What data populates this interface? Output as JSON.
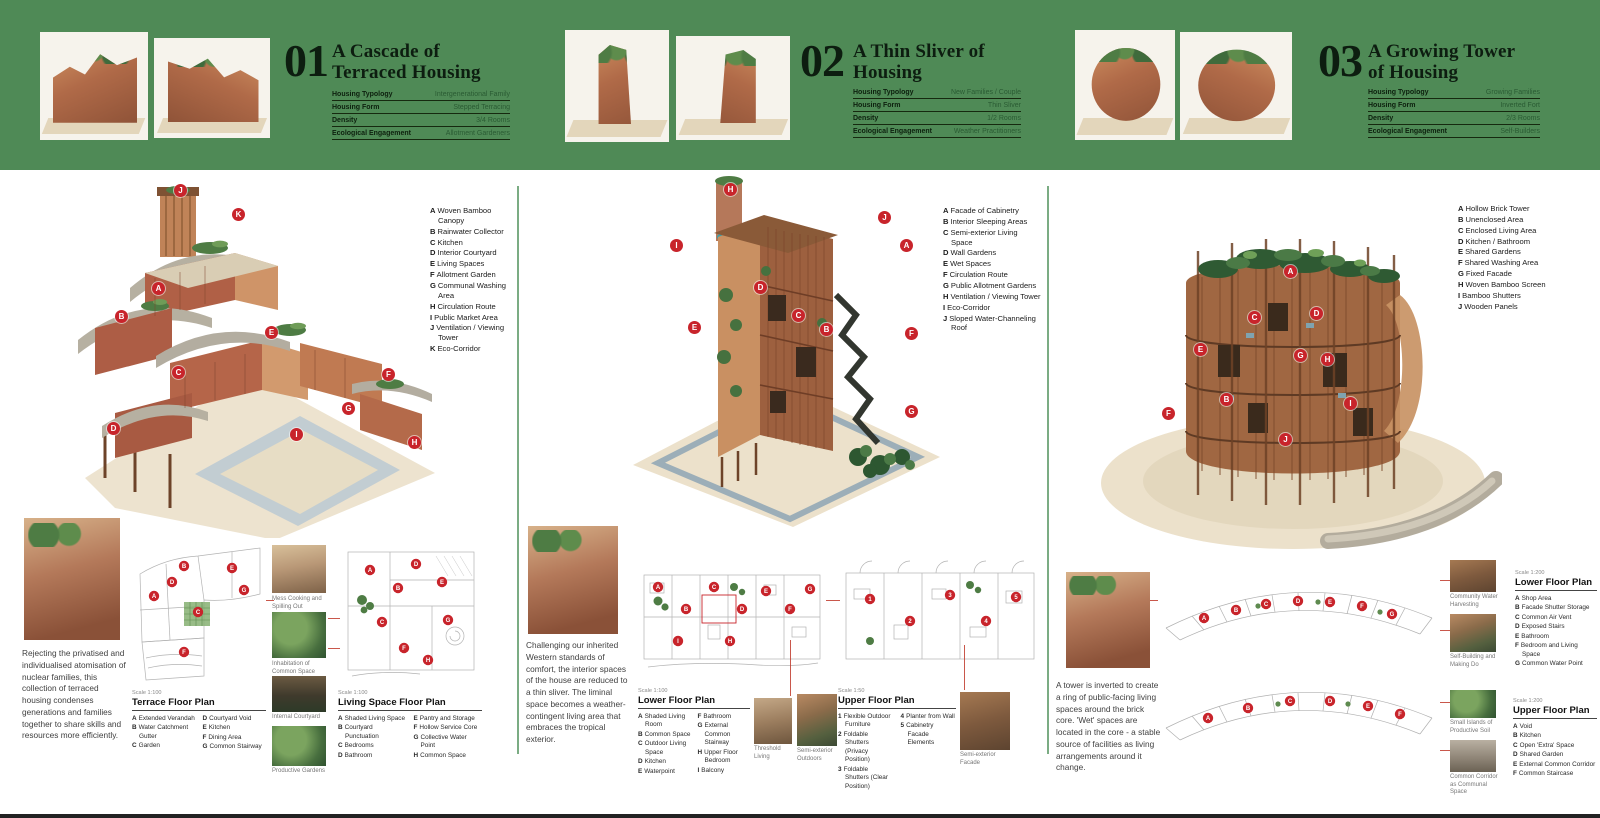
{
  "banner": {
    "bg": "#4f8a56",
    "sections": [
      {
        "number": "01",
        "title1": "A Cascade of",
        "title2": "Terraced Housing",
        "rows": [
          {
            "label": "Housing Typology",
            "value": "Intergenerational Family"
          },
          {
            "label": "Housing Form",
            "value": "Stepped Terracing"
          },
          {
            "label": "Density",
            "value": "3/4 Rooms"
          },
          {
            "label": "Ecological Engagement",
            "value": "Allotment Gardeners"
          }
        ]
      },
      {
        "number": "02",
        "title1": "A Thin Sliver of",
        "title2": "Housing",
        "rows": [
          {
            "label": "Housing Typology",
            "value": "New Families / Couple"
          },
          {
            "label": "Housing Form",
            "value": "Thin Sliver"
          },
          {
            "label": "Density",
            "value": "1/2 Rooms"
          },
          {
            "label": "Ecological Engagement",
            "value": "Weather Practitioners"
          }
        ]
      },
      {
        "number": "03",
        "title1": "A Growing Tower",
        "title2": "of Housing",
        "rows": [
          {
            "label": "Housing Typology",
            "value": "Growing Families"
          },
          {
            "label": "Housing Form",
            "value": "Inverted Fort"
          },
          {
            "label": "Density",
            "value": "2/3 Rooms"
          },
          {
            "label": "Ecological Engagement",
            "value": "Self-Builders"
          }
        ]
      }
    ]
  },
  "panels": [
    {
      "legend": [
        {
          "k": "A",
          "t": "Woven Bamboo Canopy"
        },
        {
          "k": "B",
          "t": "Rainwater Collector"
        },
        {
          "k": "C",
          "t": "Kitchen"
        },
        {
          "k": "D",
          "t": "Interior Courtyard"
        },
        {
          "k": "E",
          "t": "Living Spaces"
        },
        {
          "k": "F",
          "t": "Allotment Garden"
        },
        {
          "k": "G",
          "t": "Communal Washing Area"
        },
        {
          "k": "H",
          "t": "Circulation Route"
        },
        {
          "k": "I",
          "t": "Public Market Area"
        },
        {
          "k": "J",
          "t": "Ventilation / Viewing Tower"
        },
        {
          "k": "K",
          "t": "Eco-Corridor"
        }
      ],
      "model_markers": [
        "A",
        "B",
        "C",
        "D",
        "E",
        "F",
        "G",
        "H",
        "I",
        "J",
        "K"
      ],
      "description": "Rejecting the privatised and individualised atomisation of nuclear families, this collection of terraced housing condenses generations and families together to share skills and resources more efficiently.",
      "photo_captions": [
        "Mess Cooking and Spilling Out",
        "Inhabitation of Common Space",
        "Internal Courtyard",
        "Productive Gardens"
      ],
      "plans": [
        {
          "scale": "Scale 1:100",
          "title": "Terrace Floor Plan",
          "markers": [
            "A",
            "B",
            "C",
            "D",
            "E",
            "F",
            "G"
          ],
          "col1": [
            {
              "k": "A",
              "t": "Extended Verandah"
            },
            {
              "k": "B",
              "t": "Water Catchment Gutter"
            },
            {
              "k": "C",
              "t": "Garden"
            }
          ],
          "col2": [
            {
              "k": "D",
              "t": "Courtyard Void"
            },
            {
              "k": "E",
              "t": "Kitchen"
            },
            {
              "k": "F",
              "t": "Dining Area"
            },
            {
              "k": "G",
              "t": "Common Stairway"
            }
          ]
        },
        {
          "scale": "Scale 1:100",
          "title": "Living Space Floor Plan",
          "markers": [
            "A",
            "B",
            "C",
            "D",
            "E",
            "F",
            "G",
            "H"
          ],
          "col1": [
            {
              "k": "A",
              "t": "Shaded Living Space"
            },
            {
              "k": "B",
              "t": "Courtyard Punctuation"
            },
            {
              "k": "C",
              "t": "Bedrooms"
            },
            {
              "k": "D",
              "t": "Bathroom"
            }
          ],
          "col2": [
            {
              "k": "E",
              "t": "Pantry and Storage"
            },
            {
              "k": "F",
              "t": "Hollow Service Core"
            },
            {
              "k": "G",
              "t": "Collective Water Point"
            },
            {
              "k": "H",
              "t": "Common Space"
            }
          ]
        }
      ]
    },
    {
      "legend": [
        {
          "k": "A",
          "t": "Facade of Cabinetry"
        },
        {
          "k": "B",
          "t": "Interior Sleeping Areas"
        },
        {
          "k": "C",
          "t": "Semi-exterior Living Space"
        },
        {
          "k": "D",
          "t": "Wall Gardens"
        },
        {
          "k": "E",
          "t": "Wet Spaces"
        },
        {
          "k": "F",
          "t": "Circulation Route"
        },
        {
          "k": "G",
          "t": "Public Allotment Gardens"
        },
        {
          "k": "H",
          "t": "Ventilation / Viewing Tower"
        },
        {
          "k": "I",
          "t": "Eco-Corridor"
        },
        {
          "k": "J",
          "t": "Sloped Water-Channeling Roof"
        }
      ],
      "model_markers": [
        "A",
        "B",
        "C",
        "D",
        "E",
        "F",
        "G",
        "H",
        "I",
        "J"
      ],
      "description": "Challenging our inherited Western standards of comfort, the interior spaces of the house are reduced to a thin sliver. The liminal space becomes a weather-contingent living area that embraces the tropical exterior.",
      "plans": [
        {
          "scale": "Scale 1:100",
          "title": "Lower Floor Plan",
          "markers": [
            "A",
            "B",
            "C",
            "D",
            "E",
            "F",
            "G",
            "H",
            "I"
          ],
          "col1": [
            {
              "k": "A",
              "t": "Shaded Living Room"
            },
            {
              "k": "B",
              "t": "Common Space"
            },
            {
              "k": "C",
              "t": "Outdoor Living Space"
            },
            {
              "k": "D",
              "t": "Kitchen"
            },
            {
              "k": "E",
              "t": "Waterpoint"
            }
          ],
          "col2": [
            {
              "k": "F",
              "t": "Bathroom"
            },
            {
              "k": "G",
              "t": "External Common Stairway"
            },
            {
              "k": "H",
              "t": "Upper Floor Bedroom"
            },
            {
              "k": "I",
              "t": "Balcony"
            }
          ],
          "photos": [
            "Threshold Living",
            "Semi-exterior Outdoors"
          ]
        },
        {
          "scale": "Scale 1:50",
          "title": "Upper Floor Plan",
          "markers": [
            "1",
            "2",
            "3",
            "4",
            "5"
          ],
          "col1": [
            {
              "k": "1",
              "t": "Flexible Outdoor Furniture"
            },
            {
              "k": "2",
              "t": "Foldable Shutters (Privacy Position)"
            },
            {
              "k": "3",
              "t": "Foldable Shutters (Clear Position)"
            }
          ],
          "col2": [
            {
              "k": "4",
              "t": "Planter from Wall"
            },
            {
              "k": "5",
              "t": "Cabinetry Facade Elements"
            }
          ],
          "photos": [
            "Semi-exterior Facade"
          ]
        }
      ]
    },
    {
      "legend": [
        {
          "k": "A",
          "t": "Hollow Brick Tower"
        },
        {
          "k": "B",
          "t": "Unenclosed Area"
        },
        {
          "k": "C",
          "t": "Enclosed Living Area"
        },
        {
          "k": "D",
          "t": "Kitchen / Bathroom"
        },
        {
          "k": "E",
          "t": "Shared Gardens"
        },
        {
          "k": "F",
          "t": "Shared Washing Area"
        },
        {
          "k": "G",
          "t": "Fixed Facade"
        },
        {
          "k": "H",
          "t": "Woven Bamboo Screen"
        },
        {
          "k": "I",
          "t": "Bamboo Shutters"
        },
        {
          "k": "J",
          "t": "Wooden Panels"
        }
      ],
      "model_markers": [
        "A",
        "B",
        "C",
        "D",
        "E",
        "F",
        "G",
        "H",
        "I",
        "J"
      ],
      "description": "A tower is inverted to create a ring of public-facing living spaces around the brick core. 'Wet' spaces are located in the core - a stable source of facilities as living arrangements around it change.",
      "plans": [
        {
          "scale": "Scale 1:200",
          "title": "Lower Floor Plan",
          "markers": [
            "A",
            "B",
            "C",
            "D",
            "E",
            "F",
            "G"
          ],
          "col1": [
            {
              "k": "A",
              "t": "Shop Area"
            },
            {
              "k": "B",
              "t": "Facade Shutter Storage"
            },
            {
              "k": "C",
              "t": "Common Air Vent"
            },
            {
              "k": "D",
              "t": "Exposed Stairs"
            },
            {
              "k": "E",
              "t": "Bathroom"
            },
            {
              "k": "F",
              "t": "Bedroom and Living Space"
            },
            {
              "k": "G",
              "t": "Common Water Point"
            }
          ],
          "photos": [
            "Community Water Harvesting",
            "Self-Building and Making Do"
          ]
        },
        {
          "scale": "Scale 1:200",
          "title": "Upper Floor Plan",
          "markers": [
            "A",
            "B",
            "C",
            "D",
            "E",
            "F"
          ],
          "col1": [
            {
              "k": "A",
              "t": "Void"
            },
            {
              "k": "B",
              "t": "Kitchen"
            },
            {
              "k": "C",
              "t": "Open 'Extra' Space"
            },
            {
              "k": "D",
              "t": "Shared Garden"
            },
            {
              "k": "E",
              "t": "External Common Corridor"
            },
            {
              "k": "F",
              "t": "Common Staircase"
            }
          ],
          "photos": [
            "Small Islands of Productive Soil",
            "Common Corridor as Communal Space"
          ]
        }
      ]
    }
  ]
}
